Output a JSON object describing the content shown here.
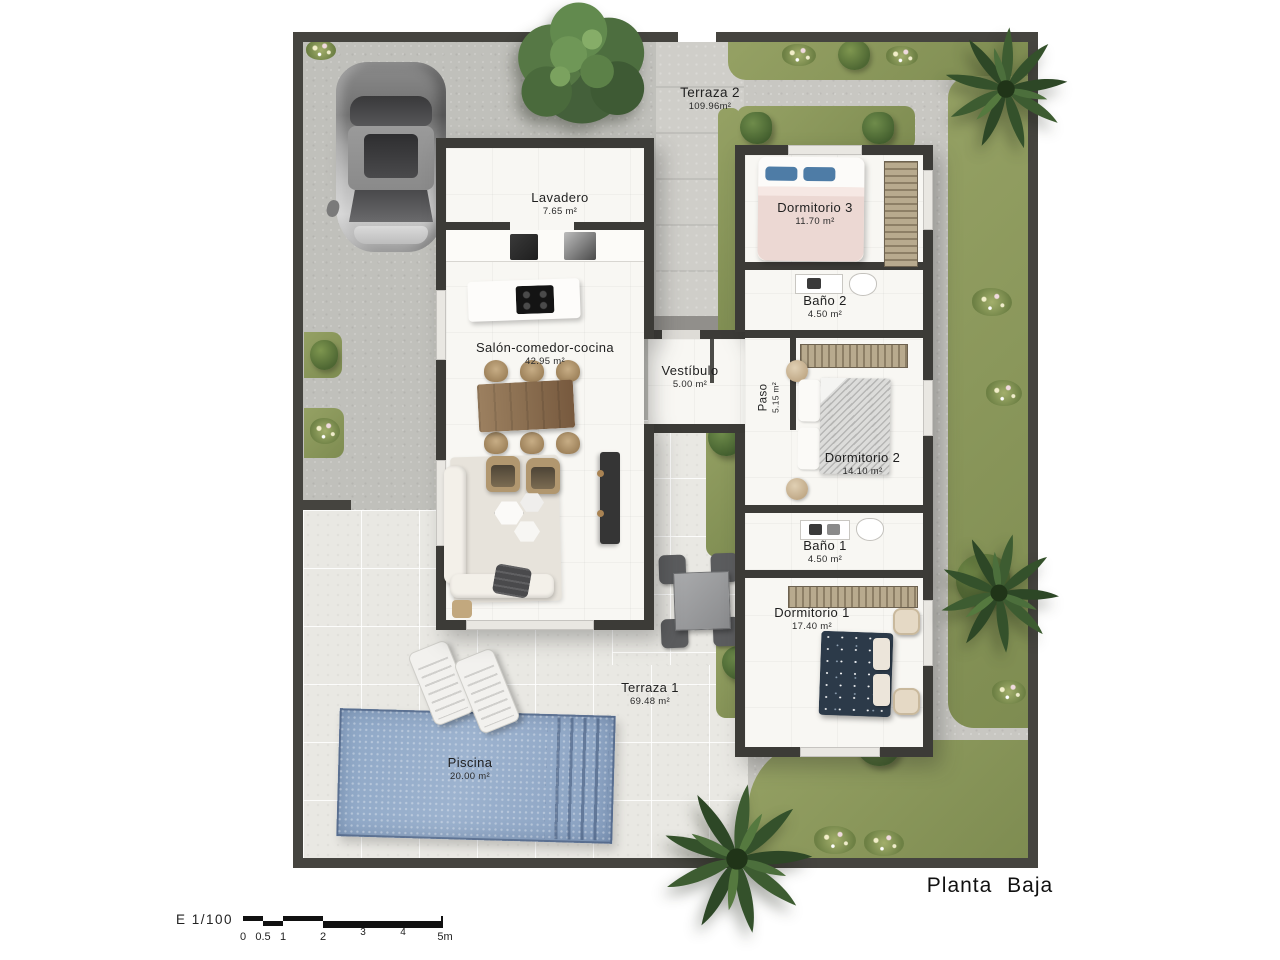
{
  "title": "Planta Baja",
  "scale": {
    "label": "E 1/100",
    "ticks": [
      "0",
      "0.5",
      "1",
      "2",
      "3",
      "4",
      "5m"
    ]
  },
  "rooms": {
    "terraza2": {
      "name": "Terraza 2",
      "area": "109.96m²"
    },
    "lavadero": {
      "name": "Lavadero",
      "area": "7.65 m²"
    },
    "salon": {
      "name": "Salón-comedor-cocina",
      "area": "42.95 m²"
    },
    "vestibulo": {
      "name": "Vestíbulo",
      "area": "5.00 m²"
    },
    "paso": {
      "name": "Paso",
      "area": "5.15 m²"
    },
    "dormitorio3": {
      "name": "Dormitorio 3",
      "area": "11.70 m²"
    },
    "bano2": {
      "name": "Baño 2",
      "area": "4.50 m²"
    },
    "dormitorio2": {
      "name": "Dormitorio 2",
      "area": "14.10 m²"
    },
    "bano1": {
      "name": "Baño 1",
      "area": "4.50 m²"
    },
    "dormitorio1": {
      "name": "Dormitorio 1",
      "area": "17.40 m²"
    },
    "terraza1": {
      "name": "Terraza 1",
      "area": "69.48 m²"
    },
    "piscina": {
      "name": "Piscina",
      "area": "20.00 m²"
    }
  },
  "colors": {
    "wall": "#45443f",
    "concrete": "#c8c7c2",
    "tile": "#e9e8e3",
    "grass": "#8f9b5f",
    "pool": "#93aac9",
    "interior": "#f8f7f3"
  }
}
